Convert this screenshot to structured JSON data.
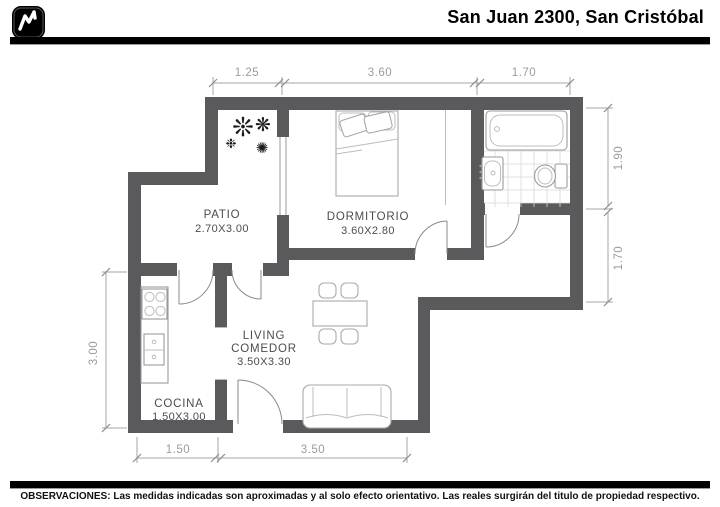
{
  "header": {
    "title": "San Juan 2300, San Cristóbal"
  },
  "rooms": {
    "patio": {
      "name": "PATIO",
      "size": "2.70X3.00"
    },
    "dormitorio": {
      "name": "DORMITORIO",
      "size": "3.60X2.80"
    },
    "living": {
      "line1": "LIVING",
      "line2": "COMEDOR",
      "size": "3.50X3.30"
    },
    "cocina": {
      "name": "COCINA",
      "size": "1.50X3.00"
    }
  },
  "dims": {
    "top": [
      "1.25",
      "3.60",
      "1.70"
    ],
    "right": [
      "1.90",
      "1.70"
    ],
    "left": [
      "3.00"
    ],
    "bottom": [
      "1.50",
      "3.50"
    ]
  },
  "icons": {
    "logo": "chart-line-logo",
    "plants": [
      "❊",
      "❋",
      "✺",
      "❉"
    ]
  },
  "colors": {
    "wall": "#5a5a5c",
    "dimension": "#9b9b9b",
    "room_label": "#4c4c4c",
    "bars": "#000000"
  },
  "footer": {
    "note": "OBSERVACIONES: Las medidas indicadas son aproximadas y al solo efecto orientativo. Las reales surgirán del titulo de propiedad respectivo."
  }
}
